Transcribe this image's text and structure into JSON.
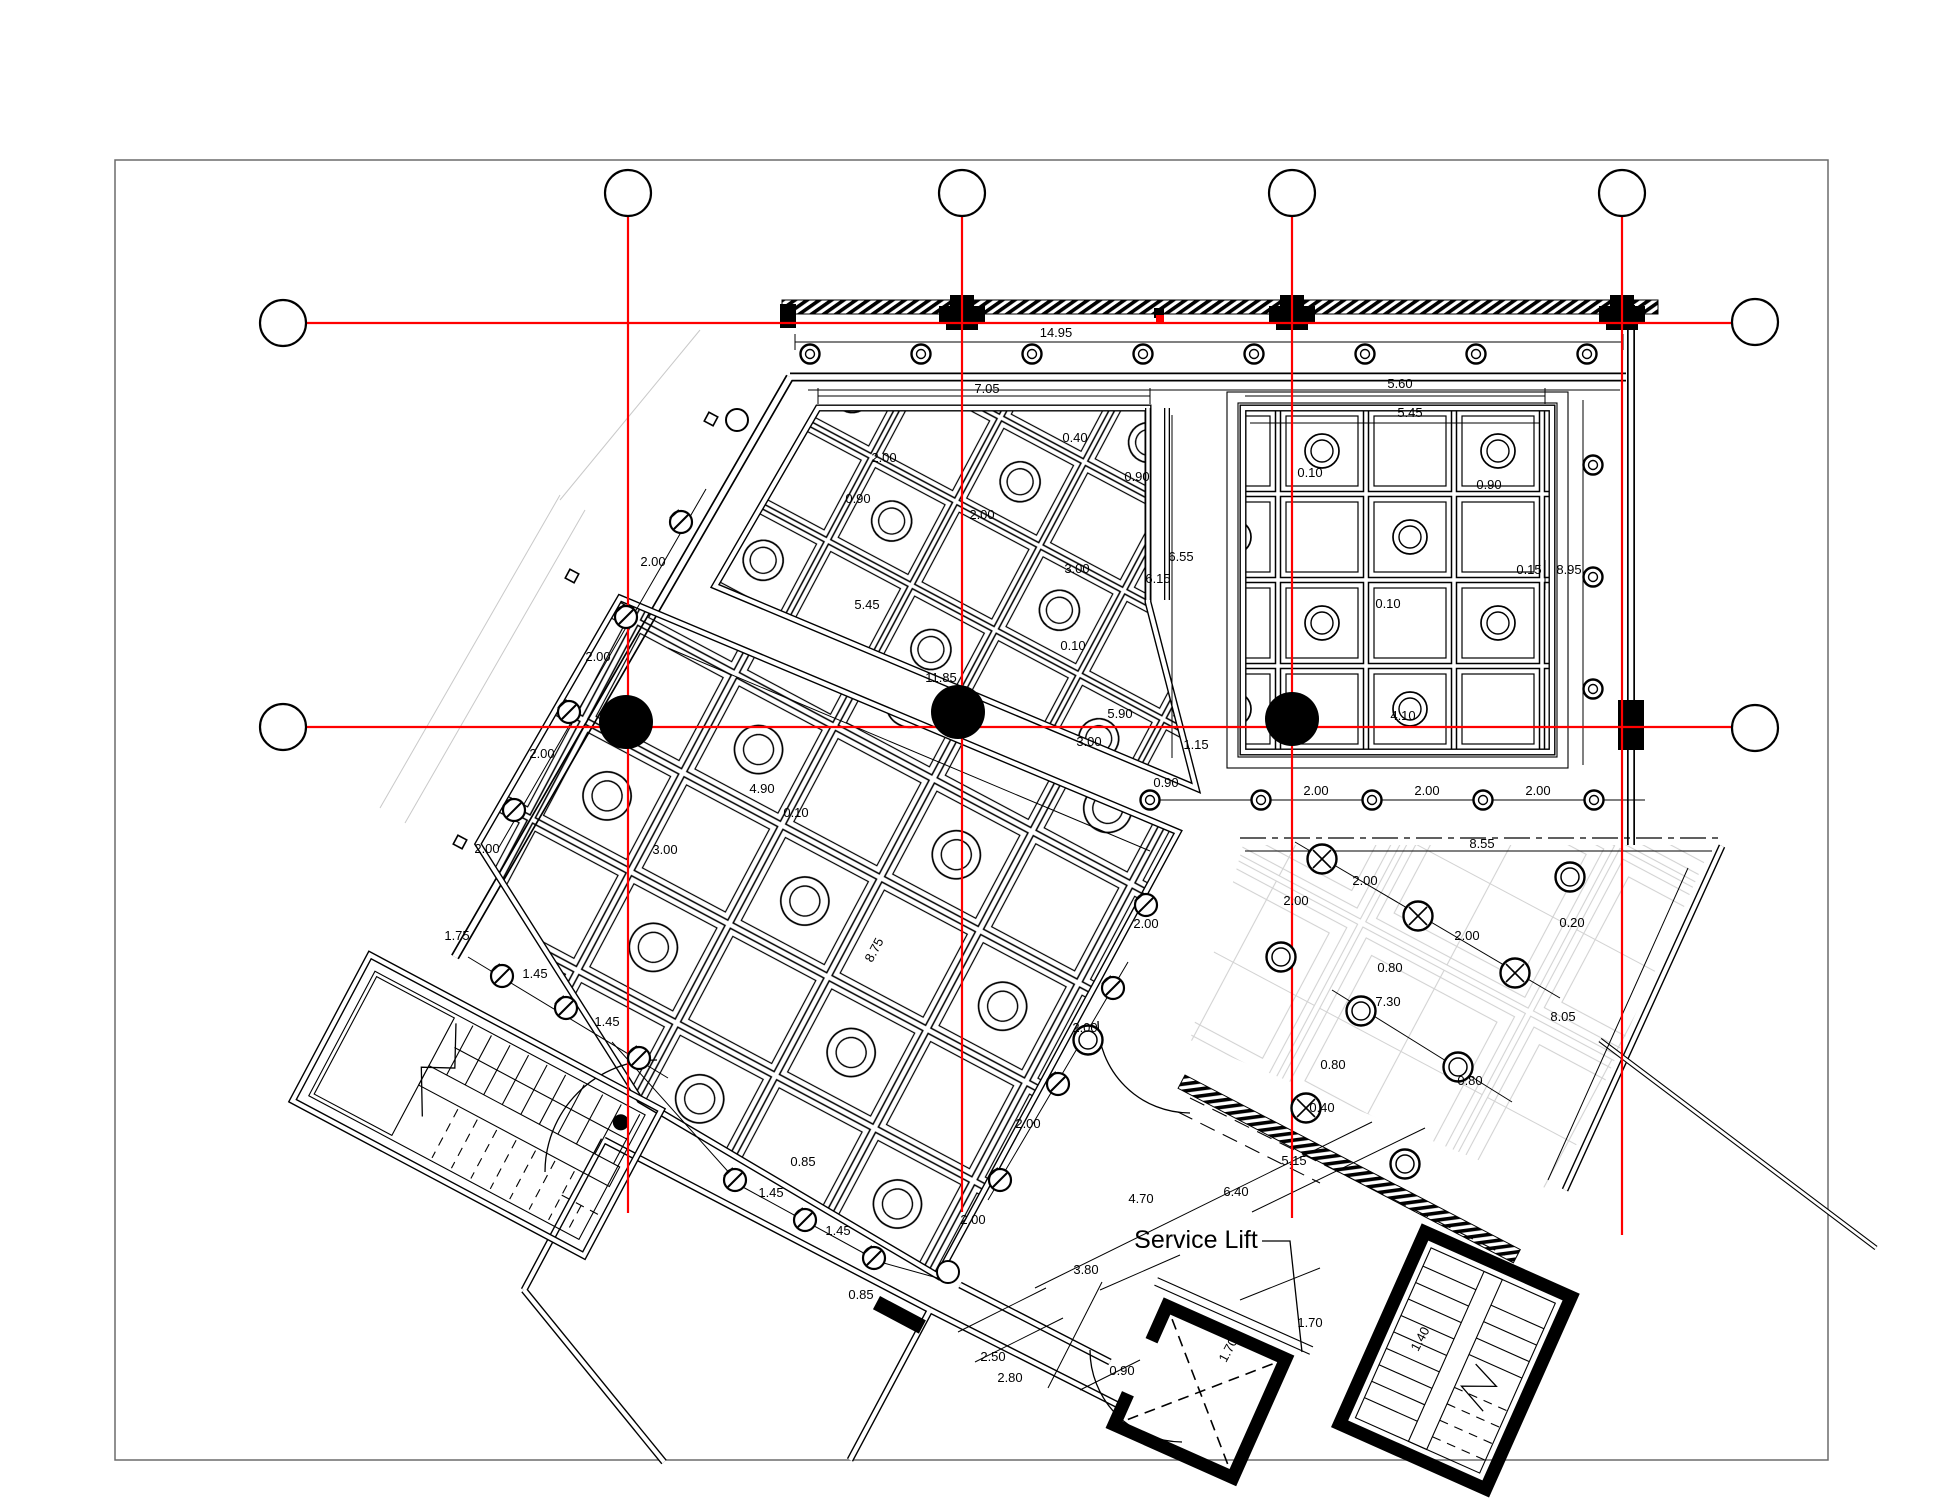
{
  "page": {
    "width": 1946,
    "height": 1504,
    "kind": "architectural floor plan drawing"
  },
  "labels": {
    "service_lift": "Service Lift"
  },
  "colors": {
    "axis_red": "#ff0000",
    "ink": "#000000",
    "paper": "#ffffff",
    "faint_grid": "#d2d2d2",
    "frame": "#6b6b6b"
  },
  "figures": {
    "axis_bubbles": [
      [
        628,
        193
      ],
      [
        962,
        193
      ],
      [
        1292,
        193
      ],
      [
        1622,
        193
      ],
      [
        283,
        323
      ],
      [
        283,
        727
      ],
      [
        1755,
        322
      ],
      [
        1755,
        728
      ]
    ],
    "red_verticals": [
      [
        628,
        216,
        1213
      ],
      [
        962,
        216,
        1212
      ],
      [
        1292,
        216,
        1218
      ],
      [
        1622,
        216,
        1235
      ]
    ],
    "red_horizontals": [
      [
        306,
        323,
        1732
      ],
      [
        306,
        727,
        1732
      ]
    ],
    "column_dots": [
      [
        626,
        722
      ],
      [
        958,
        712
      ],
      [
        1292,
        719
      ]
    ],
    "circle_row_top": {
      "y": 354,
      "xs": [
        810,
        921,
        1032,
        1143,
        1254,
        1365,
        1476,
        1587
      ]
    },
    "circle_col_right": {
      "x": 1593,
      "ys": [
        465,
        577,
        689
      ]
    },
    "circle_row_bottom": {
      "y": 800,
      "xs": [
        1150,
        1261,
        1372,
        1483,
        1594
      ]
    },
    "edge_symbols_hatched": [
      [
        681,
        522
      ],
      [
        626,
        617
      ],
      [
        569,
        712
      ],
      [
        514,
        810
      ],
      [
        502,
        976
      ],
      [
        566,
        1008
      ],
      [
        639,
        1058
      ],
      [
        735,
        1180
      ],
      [
        805,
        1220
      ],
      [
        874,
        1258
      ],
      [
        1113,
        988
      ],
      [
        1058,
        1084
      ],
      [
        1000,
        1180
      ],
      [
        1146,
        905
      ]
    ],
    "edge_symbols_plain": [
      [
        948,
        1272
      ],
      [
        737,
        420
      ]
    ],
    "terrace_symbols_hatched": [
      [
        1322,
        859
      ],
      [
        1418,
        916
      ],
      [
        1515,
        973
      ],
      [
        1306,
        1108
      ]
    ],
    "terrace_symbols_plain": [
      [
        1570,
        877
      ],
      [
        1361,
        1011
      ],
      [
        1458,
        1067
      ],
      [
        1405,
        1164
      ],
      [
        1281,
        957
      ],
      [
        1088,
        1040
      ]
    ],
    "tiny_squares": [
      [
        572,
        576
      ],
      [
        711,
        419
      ],
      [
        460,
        842
      ]
    ],
    "wall_capitals": [
      [
        962,
        312
      ],
      [
        1292,
        312
      ],
      [
        1622,
        312
      ]
    ],
    "dim_labels": [
      [
        "14.95",
        1056,
        337
      ],
      [
        "7.05",
        987,
        393
      ],
      [
        "5.60",
        1400,
        388
      ],
      [
        "5.45",
        1410,
        417
      ],
      [
        "6.15",
        1158,
        583
      ],
      [
        "6.55",
        1181,
        561
      ],
      [
        "0.10",
        1310,
        477
      ],
      [
        "0.90",
        1489,
        489
      ],
      [
        "0.15",
        1529,
        574
      ],
      [
        "8.95",
        1569,
        574
      ],
      [
        "0.10",
        1388,
        608
      ],
      [
        "4.10",
        1403,
        720
      ],
      [
        "2.00",
        884,
        462
      ],
      [
        "0.90",
        858,
        503
      ],
      [
        "2.00",
        982,
        519
      ],
      [
        "0.40",
        1075,
        442
      ],
      [
        "0.90",
        1137,
        481
      ],
      [
        "3.00",
        1077,
        573
      ],
      [
        "0.10",
        1073,
        650
      ],
      [
        "5.45",
        867,
        609
      ],
      [
        "11.85",
        941,
        682
      ],
      [
        "4.90",
        762,
        793
      ],
      [
        "0.10",
        796,
        817
      ],
      [
        "3.00",
        665,
        854
      ],
      [
        "5.90",
        1120,
        718
      ],
      [
        "1.15",
        1196,
        749
      ],
      [
        "0.90",
        1166,
        787
      ],
      [
        "3.00",
        1089,
        746
      ],
      [
        "2.00",
        653,
        566
      ],
      [
        "2.00",
        598,
        661
      ],
      [
        "2.00",
        542,
        758
      ],
      [
        "2.00",
        487,
        853
      ],
      [
        "1.75",
        457,
        940
      ],
      [
        "1.45",
        535,
        978
      ],
      [
        "1.45",
        607,
        1026
      ],
      [
        "0.85",
        803,
        1166
      ],
      [
        "1.45",
        771,
        1197
      ],
      [
        "1.45",
        838,
        1235
      ],
      [
        "0.85",
        861,
        1299
      ],
      [
        "2.00",
        1146,
        928
      ],
      [
        "2.00",
        1085,
        1032
      ],
      [
        "2.00",
        1028,
        1128
      ],
      [
        "2.00",
        973,
        1224
      ],
      [
        "8.75",
        878,
        952,
        -62
      ],
      [
        "8.55",
        1482,
        848
      ],
      [
        "2.00",
        1365,
        885
      ],
      [
        "2.00",
        1296,
        905
      ],
      [
        "2.00",
        1467,
        940
      ],
      [
        "0.20",
        1572,
        927
      ],
      [
        "0.80",
        1390,
        972
      ],
      [
        "7.30",
        1388,
        1006
      ],
      [
        "8.05",
        1563,
        1021
      ],
      [
        "0.80",
        1333,
        1069
      ],
      [
        "0.80",
        1470,
        1085
      ],
      [
        "0.40",
        1322,
        1112
      ],
      [
        "5.15",
        1294,
        1165
      ],
      [
        "4.70",
        1141,
        1203
      ],
      [
        "6.40",
        1236,
        1196
      ],
      [
        "3.80",
        1086,
        1274
      ],
      [
        "2.50",
        993,
        1361
      ],
      [
        "2.80",
        1010,
        1382
      ],
      [
        "0.90",
        1122,
        1375
      ],
      [
        "1.70",
        1310,
        1327
      ],
      [
        "1.70",
        1232,
        1352,
        -62
      ],
      [
        "1.40",
        1424,
        1341,
        -62
      ],
      [
        "2.00",
        1316,
        795
      ],
      [
        "2.00",
        1427,
        795
      ],
      [
        "2.00",
        1538,
        795
      ]
    ]
  }
}
